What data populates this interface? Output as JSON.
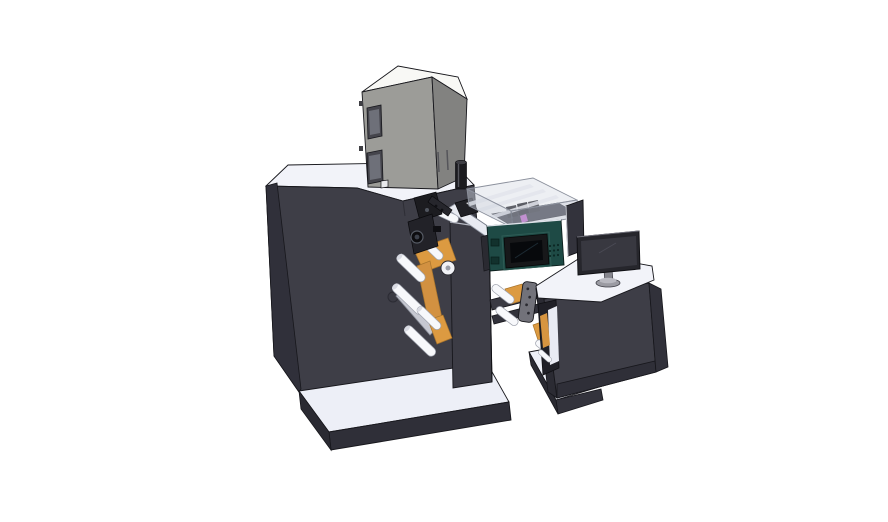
{
  "scene": {
    "description": "3D CAD rendering of a label printing press assembly: main cabinet with equipment box, unwind roller tower with web material, print mechanism, translucent inkjet enclosure with controller display, transfer bridge, and operator desk with monitor",
    "background": "#FFFFFF",
    "canvas": {
      "width": 888,
      "height": 522
    }
  },
  "colors": {
    "outline": "#17171C",
    "charcoal_front": "#3E3E47",
    "charcoal_side": "#30303A",
    "charcoal_plinth": "#2F2F38",
    "column_gray": "#3C3C45",
    "top_white": "#F2F3F9",
    "base_white": "#EDEFF7",
    "box_gray": "#9C9C98",
    "box_gray_side": "#828280",
    "box_top_white": "#F8F8F5",
    "roller_white": "#F7F8FB",
    "roller_shade": "#D9DBE3",
    "support_gray": "#C6C8D1",
    "orange_web": "#DC9A41",
    "teal_body": "#1E4A45",
    "screen_black": "#07090C",
    "bezel_black": "#17181A",
    "mech_black": "#1C1C20",
    "enclosure_glass": "#C4C9D6",
    "rail_white": "#EEF0F5",
    "magenta_head": "#C75FD0",
    "plate_gray": "#72727A",
    "monitor_bezel": "#26262C",
    "monitor_screen": "#383840",
    "stand_gray": "#9B9BA3",
    "recess_dark": "#202027"
  },
  "components": [
    {
      "id": "main-cabinet",
      "label": "Main press cabinet"
    },
    {
      "id": "equipment-box",
      "label": "Equipment box on cabinet top"
    },
    {
      "id": "roller-tower",
      "label": "Unwind roller tower with web"
    },
    {
      "id": "print-mechanism",
      "label": "Print / die station mechanism"
    },
    {
      "id": "media-column",
      "label": "Media guide column"
    },
    {
      "id": "inkjet-enclosure",
      "label": "Translucent inkjet enclosure"
    },
    {
      "id": "inkjet-controller",
      "label": "Teal controller unit with display"
    },
    {
      "id": "transfer-bridge",
      "label": "Transfer bridge conveyor"
    },
    {
      "id": "mounting-plate",
      "label": "Bolted mounting plate"
    },
    {
      "id": "operator-desk",
      "label": "Operator desk cabinet"
    },
    {
      "id": "desk-monitor",
      "label": "Desktop monitor"
    },
    {
      "id": "side-panel",
      "label": "Side divider panel"
    },
    {
      "id": "base-platforms",
      "label": "Machine base platforms"
    }
  ]
}
